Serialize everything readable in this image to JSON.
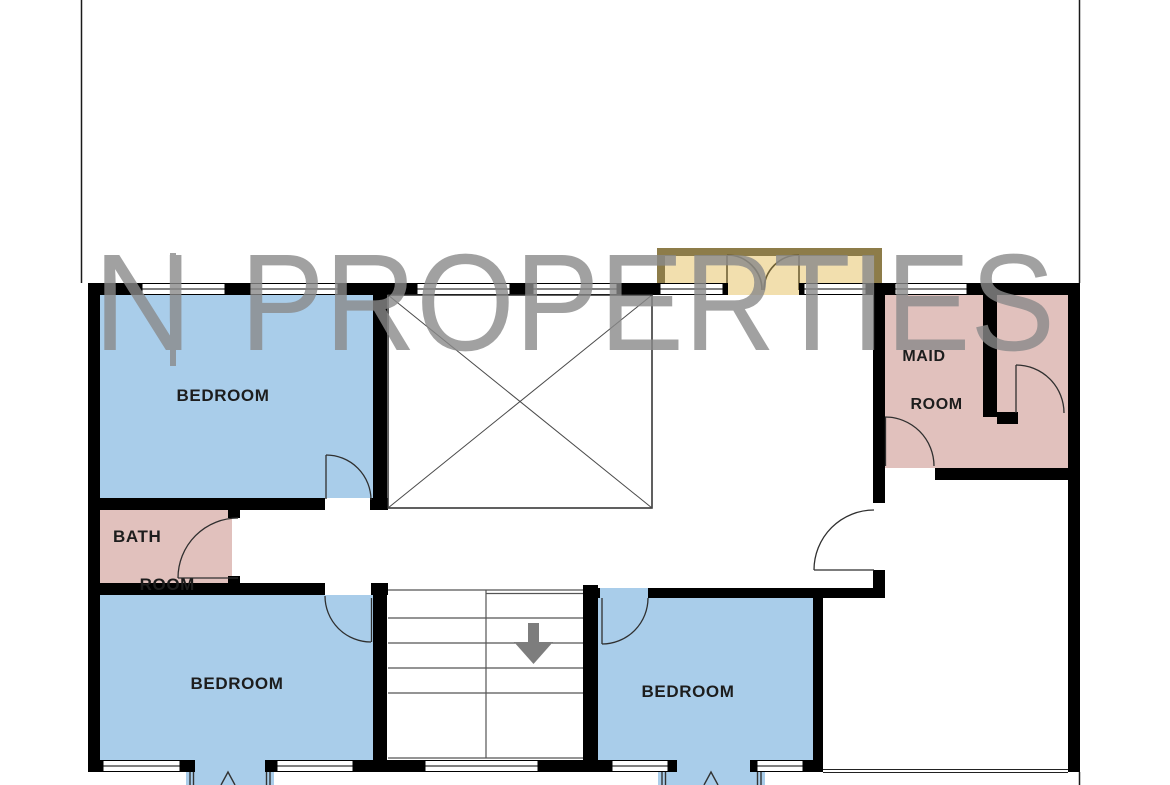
{
  "watermark": {
    "prefix": "N",
    "separator": "|",
    "word": "PROPERTIES"
  },
  "rooms": {
    "bedroom_top_left": {
      "label": "BEDROOM"
    },
    "bathroom": {
      "line1": "BATH",
      "line2": "ROOM"
    },
    "maid_room": {
      "line1": "MAID",
      "line2": "ROOM"
    },
    "bedroom_bottom_left": {
      "label": "BEDROOM"
    },
    "bedroom_bottom_center": {
      "label": "BEDROOM"
    }
  },
  "icons": {
    "stairs_down_arrow": "down-arrow",
    "void_cross": "x-cross",
    "bay_window_tick": "up-tick"
  },
  "colors": {
    "wall": "#000000",
    "bedroom_fill": "#a9cdea",
    "bath_fill": "#e1c1bd",
    "balcony_fill": "#f2dfae",
    "balcony_border": "#8d7c49",
    "watermark_gray": "#8a8a8a",
    "arrow_gray": "#7d7d7d"
  }
}
